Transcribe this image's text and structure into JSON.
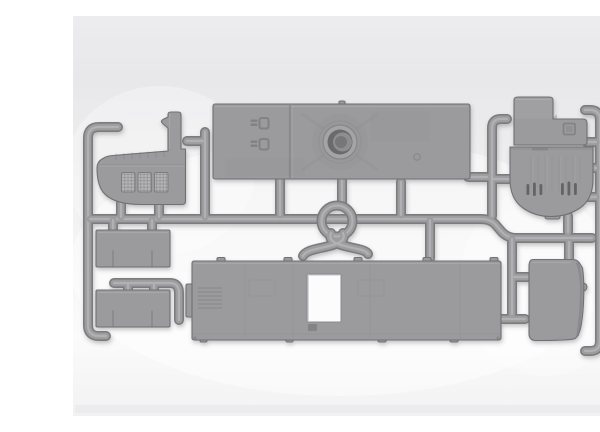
{
  "scene": {
    "description": "Product photo of a gray injection-molded plastic model-kit sprue (runner frame) holding vehicle body parts: a cab side panel with three hatched windows, a large roof deck with a circular hatch ring, an engine hood, a round-bottomed cab front with vent slots, a door panel, two bench panels, a large floor panel with a rectangular cutout, and a small ring bracket with two crossed legs, on a light gray studio background.",
    "background": {
      "page": "#ffffff",
      "top": "#ececee",
      "upper": "#e8e8ea",
      "mid": "#efeff0",
      "lower": "#f6f6f7",
      "bottom": "#f2f2f3",
      "band": "#eaeaec"
    },
    "plastic": {
      "mid": "#9b9b9e",
      "light": "#b3b3b5",
      "dark": "#7b7b7f",
      "edge": "#707074",
      "slot": "#636367",
      "hole": "#fcfcfd"
    },
    "runner": {
      "outer": "#7b7b7f",
      "core": "#9d9da0",
      "highlight": "#b8b8bb"
    },
    "parts": [
      {
        "id": "runner-left-frame",
        "label": "left sprue frame runner"
      },
      {
        "id": "runner-right-frame",
        "label": "right sprue frame runner"
      },
      {
        "id": "runner-main",
        "label": "main horizontal runner"
      },
      {
        "id": "cab-side-panel",
        "label": "cab side panel with three windows"
      },
      {
        "id": "roof-deck-panel",
        "label": "roof deck panel with circular hatch"
      },
      {
        "id": "engine-hood-panel",
        "label": "stepped engine hood panel"
      },
      {
        "id": "cab-front-panel",
        "label": "round-bottom cab front panel with vents"
      },
      {
        "id": "door-panel",
        "label": "door panel"
      },
      {
        "id": "bench-panel-upper",
        "label": "upper bench panel"
      },
      {
        "id": "bench-panel-lower",
        "label": "lower bench panel"
      },
      {
        "id": "floor-panel",
        "label": "floor panel with rectangular cutout"
      },
      {
        "id": "ring-bracket",
        "label": "ring bracket with crossed legs"
      }
    ]
  }
}
